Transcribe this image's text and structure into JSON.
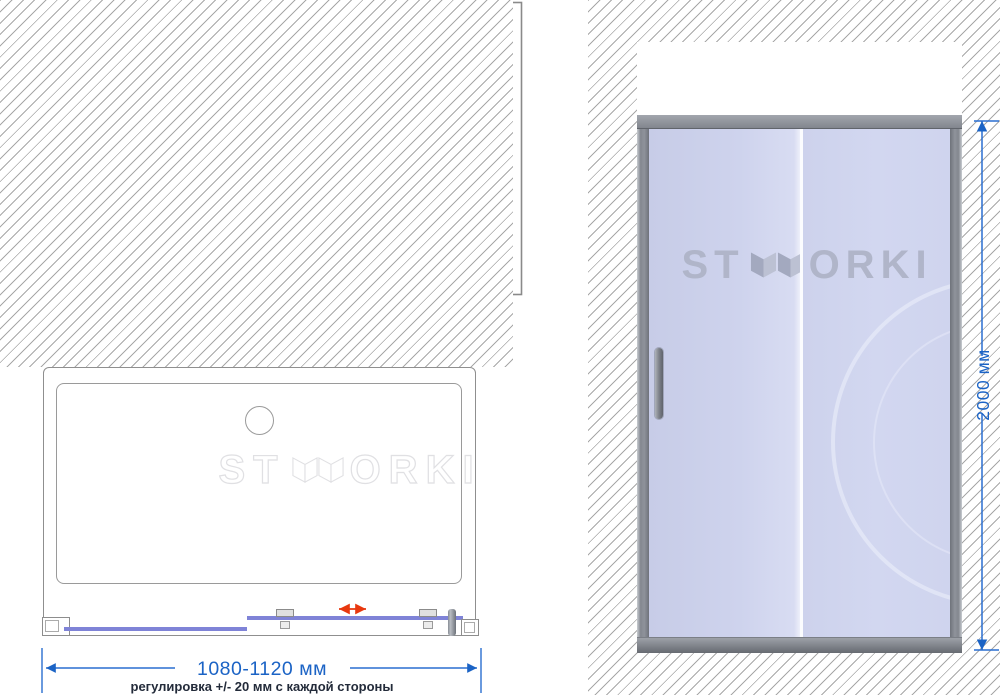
{
  "brand": {
    "prefix": "ST",
    "suffix": "ORKI",
    "name": "STWORKI"
  },
  "section_panel": {
    "caption": "ЭСКИЗ МОНТАЖНЫХ РАЗМЕРОВ В РАЗРЕЗЕ",
    "dim_total_height": "43,5",
    "dim_top_offset": "13,5",
    "dim_profile_height": "30",
    "dim_glass_overlap": "12",
    "dim_profile_width": "45+20",
    "dim_glass_thickness_top": "6",
    "dim_roller_gap": "19",
    "dim_glass_thickness_bottom": "6"
  },
  "plan_panel": {
    "width_range_label": "1080-1120 мм",
    "adjustment_note": "регулировка +/- 20 мм с каждой стороны"
  },
  "front_panel": {
    "height_label": "2000 мм"
  },
  "colors": {
    "dimension_blue": "#1b63c5",
    "drawing_line_gray": "#555555",
    "glass_front_blue": "#cdd2ec",
    "glass_plan_purple": "#7f83d7",
    "frame_gray": "#82868e",
    "arrow_red": "#e8380e",
    "watermark_front_gray": "#b0b5c9",
    "watermark_plan_outline": "#e0e0e3",
    "hatch_gray": "#a8a8a8"
  }
}
